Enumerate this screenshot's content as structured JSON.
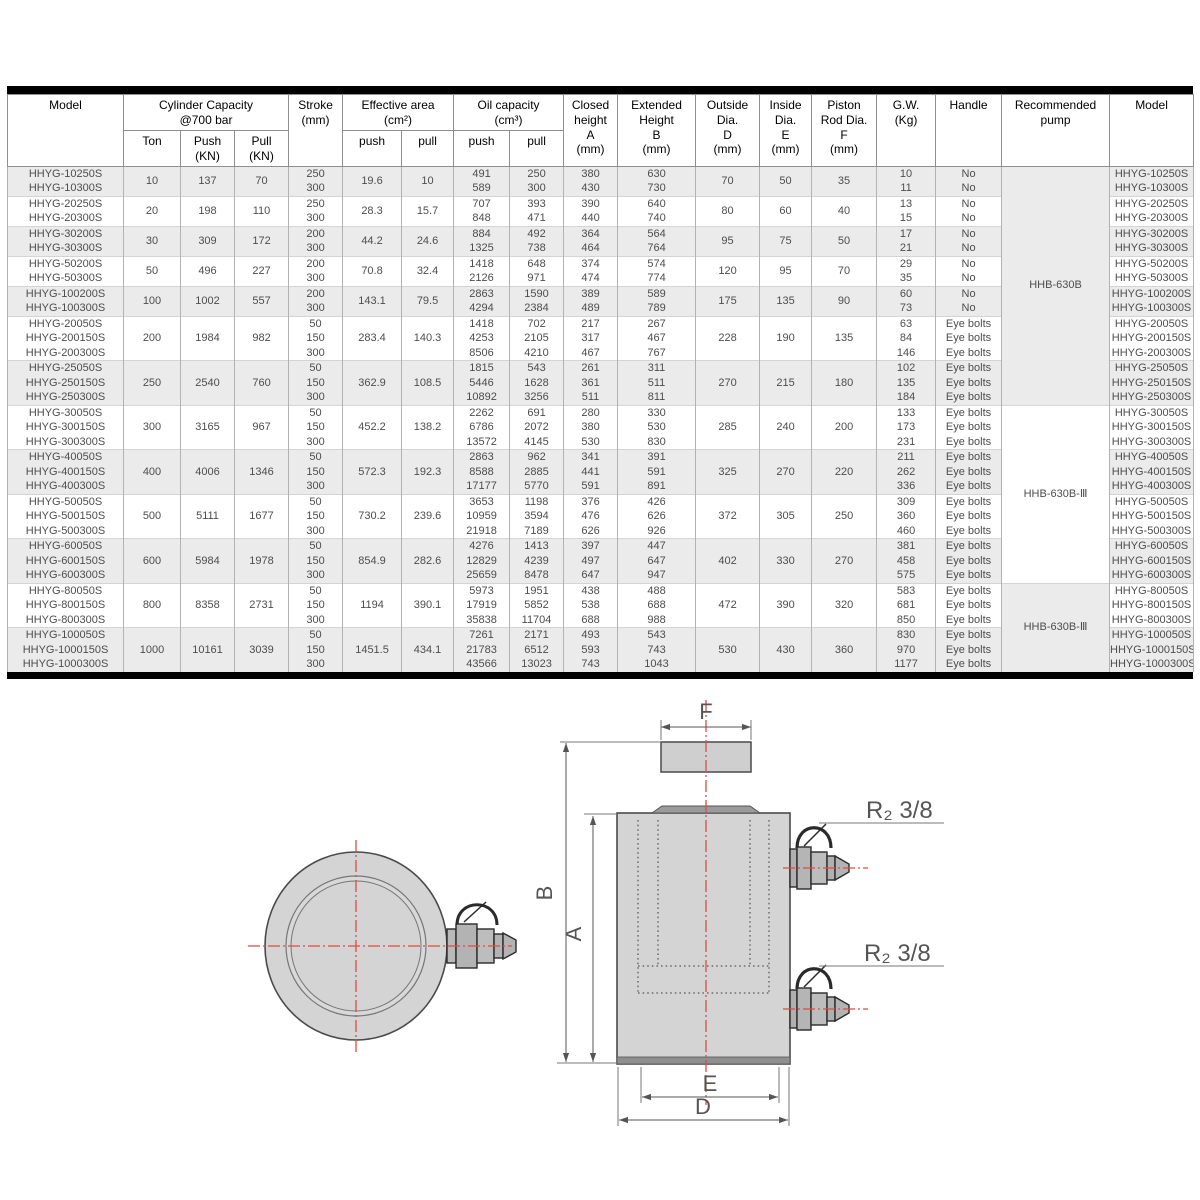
{
  "table": {
    "header": {
      "model": "Model",
      "capacity": [
        "Cylinder Capacity",
        "@700 bar"
      ],
      "ton": "Ton",
      "push_kn": [
        "Push",
        "(KN)"
      ],
      "pull_kn": [
        "Pull",
        "(KN)"
      ],
      "stroke": [
        "Stroke",
        "(mm)"
      ],
      "effective_area": [
        "Effective area",
        "(cm²)"
      ],
      "oil_capacity": [
        "Oil capacity",
        "(cm³)"
      ],
      "push": "push",
      "pull": "pull",
      "closed_height": [
        "Closed",
        "height",
        "A",
        "(mm)"
      ],
      "extended_height": [
        "Extended",
        "Height",
        "B",
        "(mm)"
      ],
      "outside_dia": [
        "Outside",
        "Dia.",
        "D",
        "(mm)"
      ],
      "inside_dia": [
        "Inside",
        "Dia.",
        "E",
        "(mm)"
      ],
      "piston_rod_dia": [
        "Piston",
        "Rod Dia.",
        "F",
        "(mm)"
      ],
      "gw": [
        "G.W.",
        "(Kg)"
      ],
      "handle": "Handle",
      "recommended_pump": [
        "Recommended",
        "pump"
      ],
      "model_right": "Model"
    },
    "colors": {
      "stripe": "#ebebeb",
      "frame": "#000000",
      "grid": "#b2b2b2"
    },
    "groups": [
      {
        "ton": "10",
        "push_kn": "137",
        "pull_kn": "70",
        "eff_push": "19.6",
        "eff_pull": "10",
        "outside_d": "70",
        "inside_e": "50",
        "rod_f": "35",
        "rows": [
          {
            "model": "HHYG-10250S",
            "stroke": "250",
            "oil_push": "491",
            "oil_pull": "250",
            "closed_a": "380",
            "extended_b": "630",
            "gw": "10",
            "handle": "No"
          },
          {
            "model": "HHYG-10300S",
            "stroke": "300",
            "oil_push": "589",
            "oil_pull": "300",
            "closed_a": "430",
            "extended_b": "730",
            "gw": "11",
            "handle": "No"
          }
        ]
      },
      {
        "ton": "20",
        "push_kn": "198",
        "pull_kn": "110",
        "eff_push": "28.3",
        "eff_pull": "15.7",
        "outside_d": "80",
        "inside_e": "60",
        "rod_f": "40",
        "rows": [
          {
            "model": "HHYG-20250S",
            "stroke": "250",
            "oil_push": "707",
            "oil_pull": "393",
            "closed_a": "390",
            "extended_b": "640",
            "gw": "13",
            "handle": "No"
          },
          {
            "model": "HHYG-20300S",
            "stroke": "300",
            "oil_push": "848",
            "oil_pull": "471",
            "closed_a": "440",
            "extended_b": "740",
            "gw": "15",
            "handle": "No"
          }
        ]
      },
      {
        "ton": "30",
        "push_kn": "309",
        "pull_kn": "172",
        "eff_push": "44.2",
        "eff_pull": "24.6",
        "outside_d": "95",
        "inside_e": "75",
        "rod_f": "50",
        "rows": [
          {
            "model": "HHYG-30200S",
            "stroke": "200",
            "oil_push": "884",
            "oil_pull": "492",
            "closed_a": "364",
            "extended_b": "564",
            "gw": "17",
            "handle": "No"
          },
          {
            "model": "HHYG-30300S",
            "stroke": "300",
            "oil_push": "1325",
            "oil_pull": "738",
            "closed_a": "464",
            "extended_b": "764",
            "gw": "21",
            "handle": "No"
          }
        ]
      },
      {
        "ton": "50",
        "push_kn": "496",
        "pull_kn": "227",
        "eff_push": "70.8",
        "eff_pull": "32.4",
        "outside_d": "120",
        "inside_e": "95",
        "rod_f": "70",
        "rows": [
          {
            "model": "HHYG-50200S",
            "stroke": "200",
            "oil_push": "1418",
            "oil_pull": "648",
            "closed_a": "374",
            "extended_b": "574",
            "gw": "29",
            "handle": "No"
          },
          {
            "model": "HHYG-50300S",
            "stroke": "300",
            "oil_push": "2126",
            "oil_pull": "971",
            "closed_a": "474",
            "extended_b": "774",
            "gw": "35",
            "handle": "No"
          }
        ]
      },
      {
        "ton": "100",
        "push_kn": "1002",
        "pull_kn": "557",
        "eff_push": "143.1",
        "eff_pull": "79.5",
        "outside_d": "175",
        "inside_e": "135",
        "rod_f": "90",
        "rows": [
          {
            "model": "HHYG-100200S",
            "stroke": "200",
            "oil_push": "2863",
            "oil_pull": "1590",
            "closed_a": "389",
            "extended_b": "589",
            "gw": "60",
            "handle": "No"
          },
          {
            "model": "HHYG-100300S",
            "stroke": "300",
            "oil_push": "4294",
            "oil_pull": "2384",
            "closed_a": "489",
            "extended_b": "789",
            "gw": "73",
            "handle": "No"
          }
        ]
      },
      {
        "ton": "200",
        "push_kn": "1984",
        "pull_kn": "982",
        "eff_push": "283.4",
        "eff_pull": "140.3",
        "outside_d": "228",
        "inside_e": "190",
        "rod_f": "135",
        "rows": [
          {
            "model": "HHYG-20050S",
            "stroke": "50",
            "oil_push": "1418",
            "oil_pull": "702",
            "closed_a": "217",
            "extended_b": "267",
            "gw": "63",
            "handle": "Eye bolts"
          },
          {
            "model": "HHYG-200150S",
            "stroke": "150",
            "oil_push": "4253",
            "oil_pull": "2105",
            "closed_a": "317",
            "extended_b": "467",
            "gw": "84",
            "handle": "Eye bolts"
          },
          {
            "model": "HHYG-200300S",
            "stroke": "300",
            "oil_push": "8506",
            "oil_pull": "4210",
            "closed_a": "467",
            "extended_b": "767",
            "gw": "146",
            "handle": "Eye bolts"
          }
        ]
      },
      {
        "ton": "250",
        "push_kn": "2540",
        "pull_kn": "760",
        "eff_push": "362.9",
        "eff_pull": "108.5",
        "outside_d": "270",
        "inside_e": "215",
        "rod_f": "180",
        "rows": [
          {
            "model": "HHYG-25050S",
            "stroke": "50",
            "oil_push": "1815",
            "oil_pull": "543",
            "closed_a": "261",
            "extended_b": "311",
            "gw": "102",
            "handle": "Eye bolts"
          },
          {
            "model": "HHYG-250150S",
            "stroke": "150",
            "oil_push": "5446",
            "oil_pull": "1628",
            "closed_a": "361",
            "extended_b": "511",
            "gw": "135",
            "handle": "Eye bolts"
          },
          {
            "model": "HHYG-250300S",
            "stroke": "300",
            "oil_push": "10892",
            "oil_pull": "3256",
            "closed_a": "511",
            "extended_b": "811",
            "gw": "184",
            "handle": "Eye bolts"
          }
        ]
      },
      {
        "ton": "300",
        "push_kn": "3165",
        "pull_kn": "967",
        "eff_push": "452.2",
        "eff_pull": "138.2",
        "outside_d": "285",
        "inside_e": "240",
        "rod_f": "200",
        "rows": [
          {
            "model": "HHYG-30050S",
            "stroke": "50",
            "oil_push": "2262",
            "oil_pull": "691",
            "closed_a": "280",
            "extended_b": "330",
            "gw": "133",
            "handle": "Eye bolts"
          },
          {
            "model": "HHYG-300150S",
            "stroke": "150",
            "oil_push": "6786",
            "oil_pull": "2072",
            "closed_a": "380",
            "extended_b": "530",
            "gw": "173",
            "handle": "Eye bolts"
          },
          {
            "model": "HHYG-300300S",
            "stroke": "300",
            "oil_push": "13572",
            "oil_pull": "4145",
            "closed_a": "530",
            "extended_b": "830",
            "gw": "231",
            "handle": "Eye bolts"
          }
        ]
      },
      {
        "ton": "400",
        "push_kn": "4006",
        "pull_kn": "1346",
        "eff_push": "572.3",
        "eff_pull": "192.3",
        "outside_d": "325",
        "inside_e": "270",
        "rod_f": "220",
        "rows": [
          {
            "model": "HHYG-40050S",
            "stroke": "50",
            "oil_push": "2863",
            "oil_pull": "962",
            "closed_a": "341",
            "extended_b": "391",
            "gw": "211",
            "handle": "Eye bolts"
          },
          {
            "model": "HHYG-400150S",
            "stroke": "150",
            "oil_push": "8588",
            "oil_pull": "2885",
            "closed_a": "441",
            "extended_b": "591",
            "gw": "262",
            "handle": "Eye bolts"
          },
          {
            "model": "HHYG-400300S",
            "stroke": "300",
            "oil_push": "17177",
            "oil_pull": "5770",
            "closed_a": "591",
            "extended_b": "891",
            "gw": "336",
            "handle": "Eye bolts"
          }
        ]
      },
      {
        "ton": "500",
        "push_kn": "5111",
        "pull_kn": "1677",
        "eff_push": "730.2",
        "eff_pull": "239.6",
        "outside_d": "372",
        "inside_e": "305",
        "rod_f": "250",
        "rows": [
          {
            "model": "HHYG-50050S",
            "stroke": "50",
            "oil_push": "3653",
            "oil_pull": "1198",
            "closed_a": "376",
            "extended_b": "426",
            "gw": "309",
            "handle": "Eye bolts"
          },
          {
            "model": "HHYG-500150S",
            "stroke": "150",
            "oil_push": "10959",
            "oil_pull": "3594",
            "closed_a": "476",
            "extended_b": "626",
            "gw": "360",
            "handle": "Eye bolts"
          },
          {
            "model": "HHYG-500300S",
            "stroke": "300",
            "oil_push": "21918",
            "oil_pull": "7189",
            "closed_a": "626",
            "extended_b": "926",
            "gw": "460",
            "handle": "Eye bolts"
          }
        ]
      },
      {
        "ton": "600",
        "push_kn": "5984",
        "pull_kn": "1978",
        "eff_push": "854.9",
        "eff_pull": "282.6",
        "outside_d": "402",
        "inside_e": "330",
        "rod_f": "270",
        "rows": [
          {
            "model": "HHYG-60050S",
            "stroke": "50",
            "oil_push": "4276",
            "oil_pull": "1413",
            "closed_a": "397",
            "extended_b": "447",
            "gw": "381",
            "handle": "Eye bolts"
          },
          {
            "model": "HHYG-600150S",
            "stroke": "150",
            "oil_push": "12829",
            "oil_pull": "4239",
            "closed_a": "497",
            "extended_b": "647",
            "gw": "458",
            "handle": "Eye bolts"
          },
          {
            "model": "HHYG-600300S",
            "stroke": "300",
            "oil_push": "25659",
            "oil_pull": "8478",
            "closed_a": "647",
            "extended_b": "947",
            "gw": "575",
            "handle": "Eye bolts"
          }
        ]
      },
      {
        "ton": "800",
        "push_kn": "8358",
        "pull_kn": "2731",
        "eff_push": "1194",
        "eff_pull": "390.1",
        "outside_d": "472",
        "inside_e": "390",
        "rod_f": "320",
        "rows": [
          {
            "model": "HHYG-80050S",
            "stroke": "50",
            "oil_push": "5973",
            "oil_pull": "1951",
            "closed_a": "438",
            "extended_b": "488",
            "gw": "583",
            "handle": "Eye bolts"
          },
          {
            "model": "HHYG-800150S",
            "stroke": "150",
            "oil_push": "17919",
            "oil_pull": "5852",
            "closed_a": "538",
            "extended_b": "688",
            "gw": "681",
            "handle": "Eye bolts"
          },
          {
            "model": "HHYG-800300S",
            "stroke": "300",
            "oil_push": "35838",
            "oil_pull": "11704",
            "closed_a": "688",
            "extended_b": "988",
            "gw": "850",
            "handle": "Eye bolts"
          }
        ]
      },
      {
        "ton": "1000",
        "push_kn": "10161",
        "pull_kn": "3039",
        "eff_push": "1451.5",
        "eff_pull": "434.1",
        "outside_d": "530",
        "inside_e": "430",
        "rod_f": "360",
        "rows": [
          {
            "model": "HHYG-100050S",
            "stroke": "50",
            "oil_push": "7261",
            "oil_pull": "2171",
            "closed_a": "493",
            "extended_b": "543",
            "gw": "830",
            "handle": "Eye bolts"
          },
          {
            "model": "HHYG-1000150S",
            "stroke": "150",
            "oil_push": "21783",
            "oil_pull": "6512",
            "closed_a": "593",
            "extended_b": "743",
            "gw": "970",
            "handle": "Eye bolts"
          },
          {
            "model": "HHYG-1000300S",
            "stroke": "300",
            "oil_push": "43566",
            "oil_pull": "13023",
            "closed_a": "743",
            "extended_b": "1043",
            "gw": "1177",
            "handle": "Eye bolts"
          }
        ]
      }
    ],
    "pump_spans": [
      {
        "label": "HHB-630B",
        "from_group": 0,
        "to_group": 6,
        "shaded": true
      },
      {
        "label": "HHB-630B-Ⅲ",
        "from_group": 7,
        "to_group": 10,
        "shaded": false
      },
      {
        "label": "HHB-630B-Ⅲ",
        "from_group": 11,
        "to_group": 12,
        "shaded": true
      }
    ]
  },
  "drawing": {
    "dim_labels": {
      "a": "A",
      "b": "B",
      "d": "D",
      "e": "E",
      "f": "F"
    },
    "port_label": "R₂ 3/8"
  }
}
